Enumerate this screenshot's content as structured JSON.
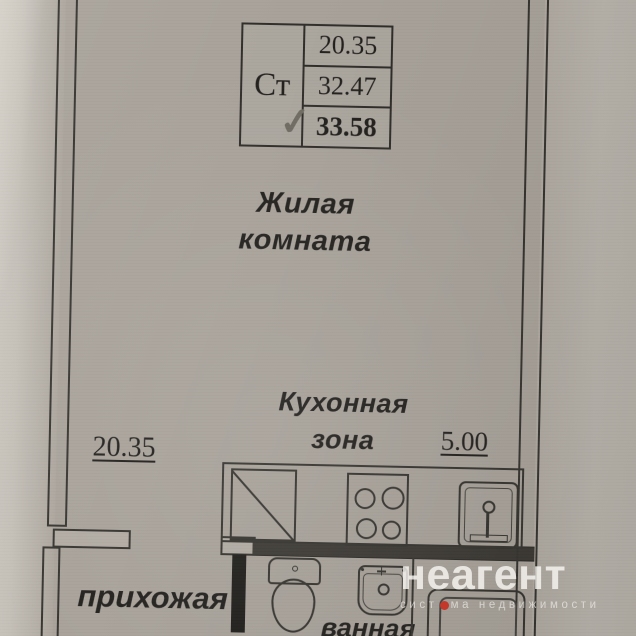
{
  "area_table": {
    "type_label": "Ст",
    "rows": [
      "20.35",
      "32.47",
      "33.58"
    ]
  },
  "icons": {
    "checkmark": "✓"
  },
  "rooms": {
    "living": {
      "label_line1": "Жилая",
      "label_line2": "комната",
      "area": "20.35"
    },
    "kitchen": {
      "label_line1": "Кухонная",
      "label_line2": "зона",
      "area": "5.00"
    },
    "hallway": {
      "label": "прихожая"
    },
    "bathroom": {
      "label": "ванная"
    }
  },
  "watermark": {
    "brand": "неагент",
    "tagline_part1": "сист",
    "tagline_dot_letter": "е",
    "tagline_part2": "ма недвижимости",
    "brand_dot_color": "#c4372b"
  },
  "colors": {
    "paper": "#a7a199",
    "line": "#35332e",
    "ink": "#211f1c"
  }
}
